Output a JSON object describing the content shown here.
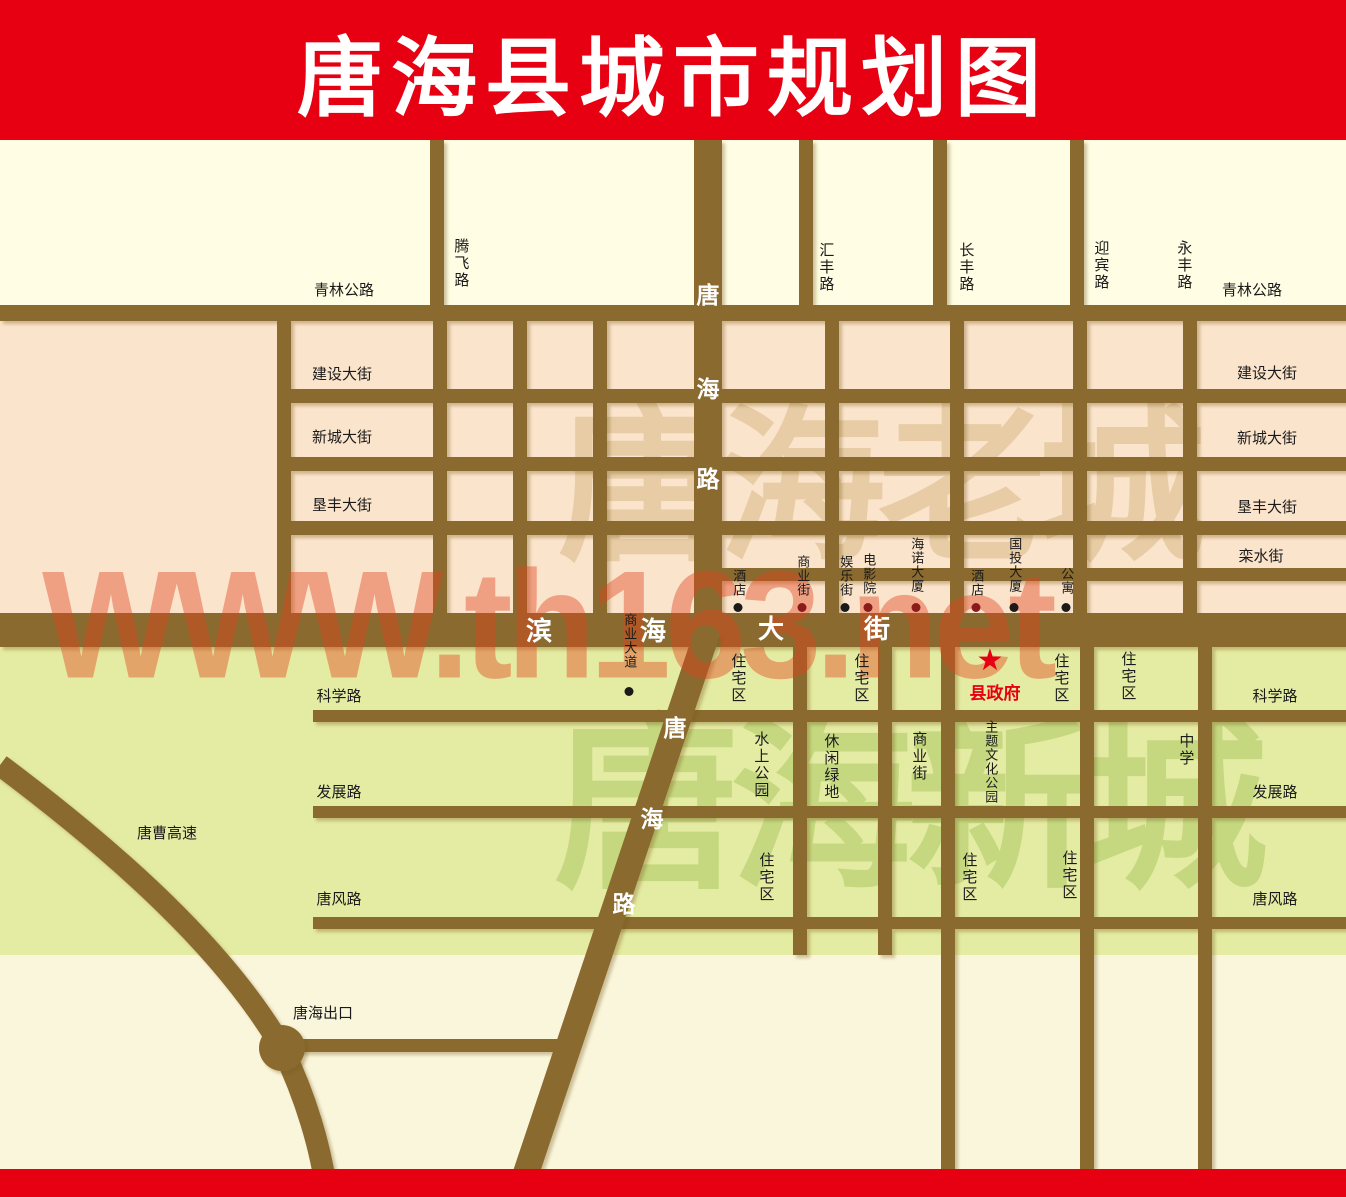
{
  "title": "唐海县城市规划图",
  "colors": {
    "header_bg": "#E60012",
    "accent": "#E60012",
    "cream": "#FFFDE3",
    "pink": "#FBE4CC",
    "green": "#E4EBA2",
    "cream_bottom": "#FAF6DC",
    "road": "#8A6B2F",
    "wm_site": "#E2431E",
    "old_city_wm": "#E3C79D",
    "new_city_wm": "#C2D77D"
  },
  "watermarks": {
    "site": {
      "text": "WWW.th163.net",
      "x": 42,
      "y": 552,
      "size": 146
    },
    "old_city": {
      "text": "唐海老城",
      "x": 558,
      "y": 405,
      "size": 168
    },
    "new_city": {
      "text": "唐海新城",
      "x": 554,
      "y": 716,
      "size": 186
    }
  },
  "government": {
    "star_glyph": "★",
    "label": "县政府",
    "star_x": 990,
    "star_y": 646,
    "label_x": 995,
    "label_y": 679
  },
  "labels": [
    {
      "n": "qinglin-road-label-left",
      "t": "青林公路",
      "x": 344,
      "y": 283,
      "k": "h"
    },
    {
      "n": "qinglin-road-label-right",
      "t": "青林公路",
      "x": 1252,
      "y": 283,
      "k": "h"
    },
    {
      "n": "tengfei-road-label",
      "t": "腾飞路",
      "x": 460,
      "y": 238,
      "k": "v"
    },
    {
      "n": "huifeng-road-label",
      "t": "汇丰路",
      "x": 825,
      "y": 242,
      "k": "v"
    },
    {
      "n": "changfeng-road-label",
      "t": "长丰路",
      "x": 965,
      "y": 242,
      "k": "v"
    },
    {
      "n": "yingbin-road-label",
      "t": "迎宾路",
      "x": 1100,
      "y": 240,
      "k": "v"
    },
    {
      "n": "yongfeng-road-label",
      "t": "永丰路",
      "x": 1183,
      "y": 240,
      "k": "v"
    },
    {
      "n": "tanghai-road-char-tang",
      "t": "唐",
      "x": 708,
      "y": 283,
      "k": "w"
    },
    {
      "n": "tanghai-road-char-hai",
      "t": "海",
      "x": 708,
      "y": 377,
      "k": "w"
    },
    {
      "n": "tanghai-road-char-lu",
      "t": "路",
      "x": 708,
      "y": 467,
      "k": "w"
    },
    {
      "n": "jianshe-street-label-left",
      "t": "建设大街",
      "x": 342,
      "y": 367,
      "k": "h"
    },
    {
      "n": "xincheng-street-label-left",
      "t": "新城大街",
      "x": 342,
      "y": 430,
      "k": "h"
    },
    {
      "n": "kenfeng-street-label-left",
      "t": "垦丰大街",
      "x": 342,
      "y": 498,
      "k": "h"
    },
    {
      "n": "jianshe-street-label-right",
      "t": "建设大街",
      "x": 1267,
      "y": 366,
      "k": "h"
    },
    {
      "n": "xincheng-street-label-right",
      "t": "新城大街",
      "x": 1267,
      "y": 431,
      "k": "h"
    },
    {
      "n": "kenfeng-street-label-right",
      "t": "垦丰大街",
      "x": 1267,
      "y": 500,
      "k": "h"
    },
    {
      "n": "luanshui-street-label",
      "t": "栾水街",
      "x": 1261,
      "y": 549,
      "k": "h"
    },
    {
      "n": "binhai-street-char-bin",
      "t": "滨",
      "x": 539,
      "y": 617,
      "k": "wb"
    },
    {
      "n": "binhai-street-char-hai",
      "t": "海",
      "x": 653,
      "y": 617,
      "k": "wb"
    },
    {
      "n": "binhai-street-char-da",
      "t": "大",
      "x": 771,
      "y": 615,
      "k": "wb"
    },
    {
      "n": "binhai-street-char-jie",
      "t": "街",
      "x": 877,
      "y": 615,
      "k": "wb"
    },
    {
      "n": "residential-label",
      "t": "住宅区",
      "x": 737,
      "y": 653,
      "k": "v"
    },
    {
      "n": "residential-label",
      "t": "住宅区",
      "x": 860,
      "y": 653,
      "k": "v"
    },
    {
      "n": "residential-label",
      "t": "住宅区",
      "x": 1060,
      "y": 653,
      "k": "v"
    },
    {
      "n": "residential-label",
      "t": "住宅区",
      "x": 1127,
      "y": 651,
      "k": "v"
    },
    {
      "n": "kexue-road-label-left",
      "t": "科学路",
      "x": 339,
      "y": 689,
      "k": "h"
    },
    {
      "n": "kexue-road-label-right",
      "t": "科学路",
      "x": 1275,
      "y": 689,
      "k": "h"
    },
    {
      "n": "shuishang-park-label",
      "t": "水上公园",
      "x": 760,
      "y": 731,
      "k": "v"
    },
    {
      "n": "xiuxian-green-label",
      "t": "休闲绿地",
      "x": 830,
      "y": 733,
      "k": "v"
    },
    {
      "n": "shangye-street-south-label",
      "t": "商业街",
      "x": 918,
      "y": 731,
      "k": "v"
    },
    {
      "n": "theme-culture-park-label",
      "t": "主题文化公园",
      "x": 990,
      "y": 720,
      "k": "vp"
    },
    {
      "n": "middle-school-label",
      "t": "中学",
      "x": 1185,
      "y": 733,
      "k": "v"
    },
    {
      "n": "fazhan-road-label-left",
      "t": "发展路",
      "x": 339,
      "y": 785,
      "k": "h"
    },
    {
      "n": "fazhan-road-label-right",
      "t": "发展路",
      "x": 1275,
      "y": 785,
      "k": "h"
    },
    {
      "n": "tangcao-highway-label",
      "t": "唐曹高速",
      "x": 167,
      "y": 826,
      "k": "h"
    },
    {
      "n": "residential-label",
      "t": "住宅区",
      "x": 765,
      "y": 852,
      "k": "v"
    },
    {
      "n": "residential-label",
      "t": "住宅区",
      "x": 968,
      "y": 852,
      "k": "v"
    },
    {
      "n": "residential-label",
      "t": "住宅区",
      "x": 1068,
      "y": 850,
      "k": "v"
    },
    {
      "n": "tangfeng-road-label-left",
      "t": "唐风路",
      "x": 339,
      "y": 892,
      "k": "h"
    },
    {
      "n": "tangfeng-road-label-right",
      "t": "唐风路",
      "x": 1275,
      "y": 892,
      "k": "h"
    },
    {
      "n": "tanghai-diagonal-char-tang",
      "t": "唐",
      "x": 675,
      "y": 716,
      "k": "w"
    },
    {
      "n": "tanghai-diagonal-char-hai",
      "t": "海",
      "x": 652,
      "y": 807,
      "k": "w"
    },
    {
      "n": "tanghai-diagonal-char-lu",
      "t": "路",
      "x": 624,
      "y": 892,
      "k": "w"
    },
    {
      "n": "tanghai-exit-label",
      "t": "唐海出口",
      "x": 323,
      "y": 1006,
      "k": "h"
    }
  ],
  "pois": [
    {
      "n": "poi-hotel-west",
      "t": "酒店",
      "x": 738,
      "y": 569,
      "dc": "#1a1a1a"
    },
    {
      "n": "poi-shangye-street",
      "t": "商业街",
      "x": 802,
      "y": 555,
      "dc": "#8B1A1A"
    },
    {
      "n": "poi-yule-street",
      "t": "娱乐街",
      "x": 845,
      "y": 555,
      "dc": "#1a1a1a"
    },
    {
      "n": "poi-cinema",
      "t": "电影院",
      "x": 868,
      "y": 553,
      "dc": "#8B1A1A"
    },
    {
      "n": "poi-hainuo-tower",
      "t": "海诺大厦",
      "x": 916,
      "y": 537,
      "dc": "#8B1A1A"
    },
    {
      "n": "poi-hotel-east",
      "t": "酒店",
      "x": 976,
      "y": 569,
      "dc": "#8B1A1A"
    },
    {
      "n": "poi-guotou-tower",
      "t": "国投大厦",
      "x": 1014,
      "y": 537,
      "dc": "#1a1a1a"
    },
    {
      "n": "poi-apartment",
      "t": "公寓",
      "x": 1066,
      "y": 567,
      "dc": "#1a1a1a"
    },
    {
      "n": "poi-shangye-avenue",
      "t": "商业大道",
      "x": 629,
      "y": 613,
      "dc": "#1a1a1a",
      "dy": 687
    }
  ]
}
